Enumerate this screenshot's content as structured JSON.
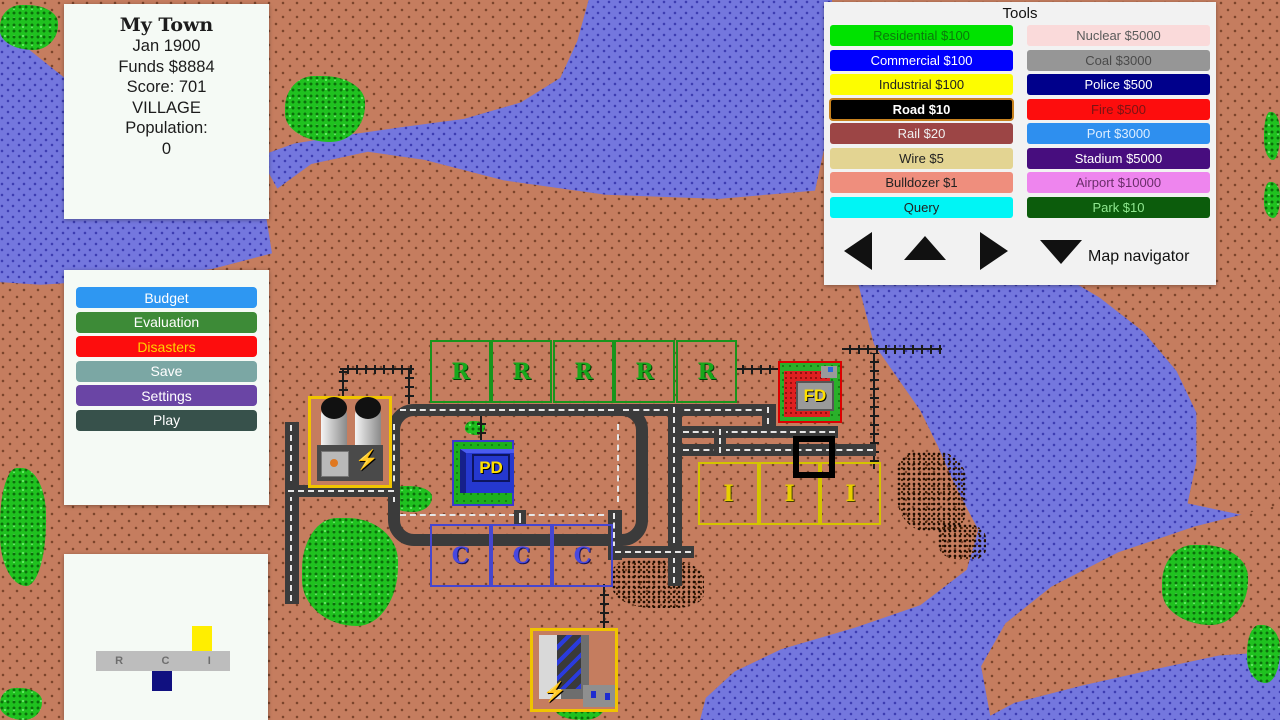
{
  "info_panel": {
    "title": "My Town",
    "date": "Jan 1900",
    "funds": "Funds $8884",
    "score": "Score: 701",
    "city_class": "VILLAGE",
    "population_label": "Population:",
    "population_value": "0"
  },
  "menu": {
    "items": [
      {
        "label": "Budget",
        "bg": "#2e97f2",
        "fg": "#ffffff"
      },
      {
        "label": "Evaluation",
        "bg": "#3d8b37",
        "fg": "#ffffff"
      },
      {
        "label": "Disasters",
        "bg": "#fd0d0d",
        "fg": "#ffd400"
      },
      {
        "label": "Save",
        "bg": "#7ba7a4",
        "fg": "#ffffff"
      },
      {
        "label": "Settings",
        "bg": "#6a45a5",
        "fg": "#ffffff"
      },
      {
        "label": "Play",
        "bg": "#37514b",
        "fg": "#ffffff"
      }
    ]
  },
  "rci": {
    "letters": [
      "R",
      "C",
      "I"
    ],
    "industrial_demand_color": "#ffee00",
    "commercial_demand_color": "#101080"
  },
  "tools": {
    "title": "Tools",
    "left": [
      {
        "label": "Residential $100",
        "bg": "#00e300",
        "fg": "#0b7a0b",
        "selected": false
      },
      {
        "label": "Commercial $100",
        "bg": "#0000fe",
        "fg": "#ffffff",
        "selected": false
      },
      {
        "label": "Industrial $100",
        "bg": "#fdfd00",
        "fg": "#222222",
        "selected": false
      },
      {
        "label": "Road $10",
        "bg": "#000000",
        "fg": "#ffffff",
        "selected": true
      },
      {
        "label": "Rail $20",
        "bg": "#9c4545",
        "fg": "#f0f0f0",
        "selected": false
      },
      {
        "label": "Wire $5",
        "bg": "#e3d492",
        "fg": "#222222",
        "selected": false
      },
      {
        "label": "Bulldozer $1",
        "bg": "#ef8e7d",
        "fg": "#222222",
        "selected": false
      },
      {
        "label": "Query",
        "bg": "#00f5f5",
        "fg": "#222222",
        "selected": false
      }
    ],
    "right": [
      {
        "label": "Nuclear $5000",
        "bg": "#fadada",
        "fg": "#5a5a5a",
        "selected": false
      },
      {
        "label": "Coal $3000",
        "bg": "#969696",
        "fg": "#4a4a4a",
        "selected": false
      },
      {
        "label": "Police $500",
        "bg": "#00008b",
        "fg": "#ffffff",
        "selected": false
      },
      {
        "label": "Fire $500",
        "bg": "#fd0d0d",
        "fg": "#7a1414",
        "selected": false
      },
      {
        "label": "Port $3000",
        "bg": "#2e8fef",
        "fg": "#dcedff",
        "selected": false
      },
      {
        "label": "Stadium $5000",
        "bg": "#470d7e",
        "fg": "#ffffff",
        "selected": false
      },
      {
        "label": "Airport $10000",
        "bg": "#ee85ee",
        "fg": "#6b2d6b",
        "selected": false
      },
      {
        "label": "Park $10",
        "bg": "#0c5c0c",
        "fg": "#90e890",
        "selected": false
      }
    ],
    "navigator_label": "Map navigator",
    "arrows": [
      "left-arrow-icon",
      "up-arrow-icon",
      "right-arrow-icon",
      "down-arrow-icon"
    ]
  },
  "map": {
    "zones": {
      "residential_letter": "R",
      "commercial_letter": "C",
      "industrial_letter": "I"
    },
    "buildings": {
      "police_label": "PD",
      "fire_label": "FD"
    },
    "icons": {
      "power_bolt": "⚡"
    },
    "colors": {
      "land": "#c57d5f",
      "water": "#7477de",
      "trees": "#1fc11f",
      "road": "#3b3b3b",
      "residential_border": "#18951c",
      "commercial_border": "#4646cf",
      "industrial_border": "#d4c400"
    }
  }
}
